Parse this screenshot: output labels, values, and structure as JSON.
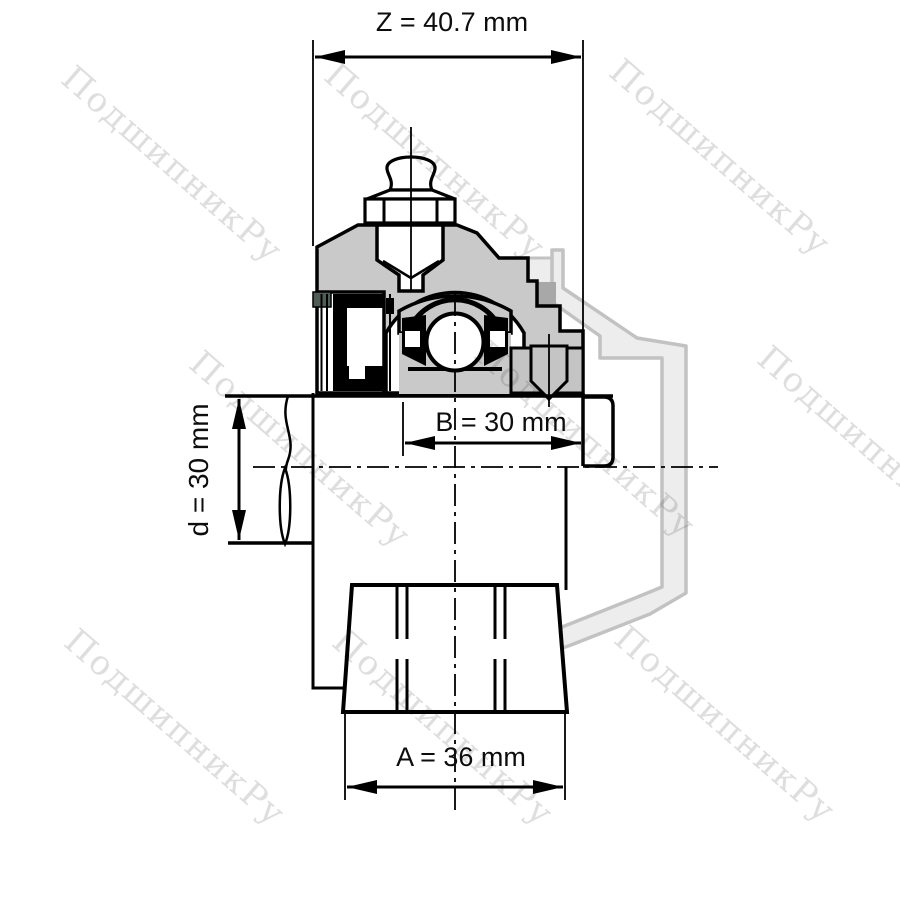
{
  "drawing": {
    "type": "technical-drawing",
    "subject": "flanged bearing unit cross-section with shaft",
    "dimensions": {
      "z": {
        "name": "Z",
        "value": 40.7,
        "unit": "mm",
        "label": "Z = 40.7 mm"
      },
      "b": {
        "name": "B",
        "value": 30,
        "unit": "mm",
        "label": "B = 30 mm"
      },
      "d": {
        "name": "d",
        "value": 30,
        "unit": "mm",
        "label": "d = 30 mm"
      },
      "a": {
        "name": "A",
        "value": 36,
        "unit": "mm",
        "label": "A = 36 mm"
      }
    },
    "colors": {
      "line": "#000000",
      "dimension_text": "#0d0d0d",
      "housing_fill": "#c9c9c9",
      "collar_fill": "#c4c4c4",
      "seal_fill": "#4f5d56",
      "phantom_fill": "#ededed",
      "phantom_line": "#c2c2c2",
      "watermark": "#dedede",
      "background": "#ffffff"
    }
  },
  "watermark": {
    "text": "ПодшипникРу"
  }
}
